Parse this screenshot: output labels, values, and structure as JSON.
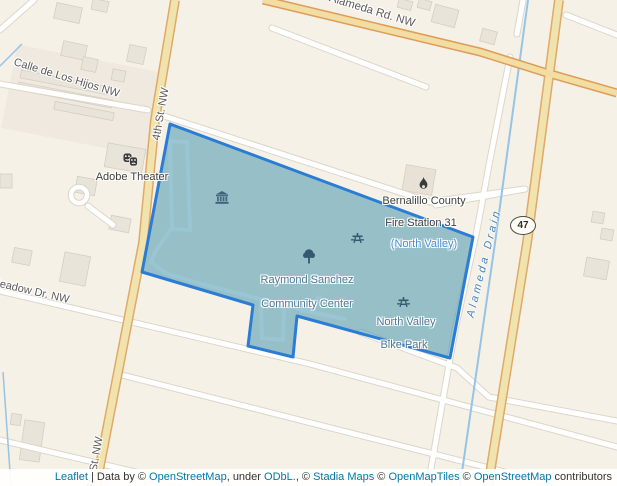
{
  "map": {
    "street_labels": {
      "calle_de_los_hijos": "Calle de Los Hijos NW",
      "fourth_st": "4th St. NW",
      "fourth_st_south": "4th St. NW",
      "alameda_rd": "Alameda Rd. NW",
      "meadow_dr": "Meadow Dr. NW"
    },
    "water_label": "Alameda Drain",
    "route_badge": "47",
    "pois": {
      "adobe_theater": "Adobe Theater",
      "fire_station_line1": "Bernalillo County",
      "fire_station_line2": "Fire Station 31",
      "fire_station_line3": "(North Valley)"
    },
    "park_labels": {
      "community_center_line1": "Raymond Sanchez",
      "community_center_line2": "Community Center",
      "bike_park_line1": "North Valley",
      "bike_park_line2": "Bike Park"
    },
    "icons": {
      "theater_masks": "theater-masks-icon",
      "fire_station": "fire-flame-icon",
      "museum": "museum-icon",
      "picnic_table_1": "picnic-table-icon",
      "tree": "tree-icon",
      "picnic_table_2": "picnic-table-icon"
    },
    "colors": {
      "land": "#f6f1e7",
      "polygon_fill": "#4796af",
      "polygon_border": "#2b7cd4",
      "tan_road_fill": "#f1e3ad",
      "tan_road_casing": "#e0a967",
      "water_line": "#96c3e6",
      "park_label": "#4d7a96",
      "link_blue": "#0078a8"
    }
  },
  "attribution": {
    "parts": [
      {
        "text": "Leaflet",
        "link": true
      },
      {
        "text": " | Data by © ",
        "link": false
      },
      {
        "text": "OpenStreetMap",
        "link": true
      },
      {
        "text": ", under ",
        "link": false
      },
      {
        "text": "ODbL.",
        "link": true
      },
      {
        "text": ", © ",
        "link": false
      },
      {
        "text": "Stadia Maps",
        "link": true
      },
      {
        "text": " © ",
        "link": false
      },
      {
        "text": "OpenMapTiles",
        "link": true
      },
      {
        "text": " © ",
        "link": false
      },
      {
        "text": "OpenStreetMap",
        "link": true
      },
      {
        "text": " contributors",
        "link": false
      }
    ]
  }
}
